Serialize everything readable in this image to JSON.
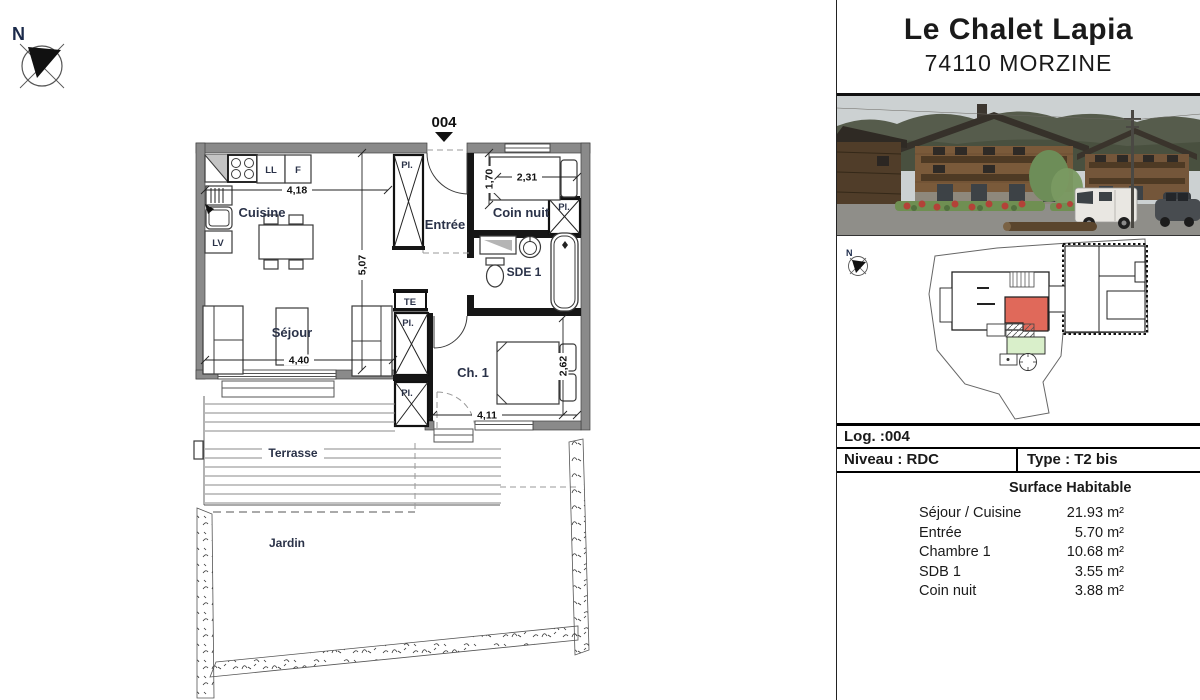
{
  "header": {
    "title": "Le Chalet Lapia",
    "subtitle": "74110 MORZINE"
  },
  "info_table": {
    "log": "Log. :004",
    "niveau": "Niveau : RDC",
    "type": "Type : T2 bis"
  },
  "surface_table": {
    "header": "Surface Habitable",
    "rows": [
      {
        "label": "Séjour / Cuisine",
        "value": "21.93 m²"
      },
      {
        "label": "Entrée",
        "value": "5.70 m²"
      },
      {
        "label": "Chambre 1",
        "value": "10.68 m²"
      },
      {
        "label": "SDB 1",
        "value": "3.55 m²"
      },
      {
        "label": "Coin nuit",
        "value": "3.88 m²"
      }
    ]
  },
  "floor_plan": {
    "unit": "004",
    "north": "N",
    "rooms": {
      "cuisine": "Cuisine",
      "sejour": "Séjour",
      "entree": "Entrée",
      "coin_nuit": "Coin nuit",
      "sde": "SDE 1",
      "chambre": "Ch. 1",
      "terrasse": "Terrasse",
      "jardin": "Jardin"
    },
    "fixtures": {
      "ll": "LL",
      "f": "F",
      "lv": "LV",
      "te": "TE",
      "pl": "Pl."
    },
    "dimensions": {
      "sejour_width": "4,18",
      "sejour_height": "5,07",
      "coin_nuit_width": "2,31",
      "coin_nuit_depth": "1,70",
      "sejour_bottom": "4,40",
      "chambre_width": "4,11",
      "chambre_depth": "2,62"
    }
  },
  "site_plan": {
    "north": "N",
    "colors": {
      "unit_highlight": "#e0695a",
      "garden": "#d9efca"
    }
  },
  "colors": {
    "wall_gray": "#8a8a8a",
    "label_blue": "#2a3248"
  }
}
